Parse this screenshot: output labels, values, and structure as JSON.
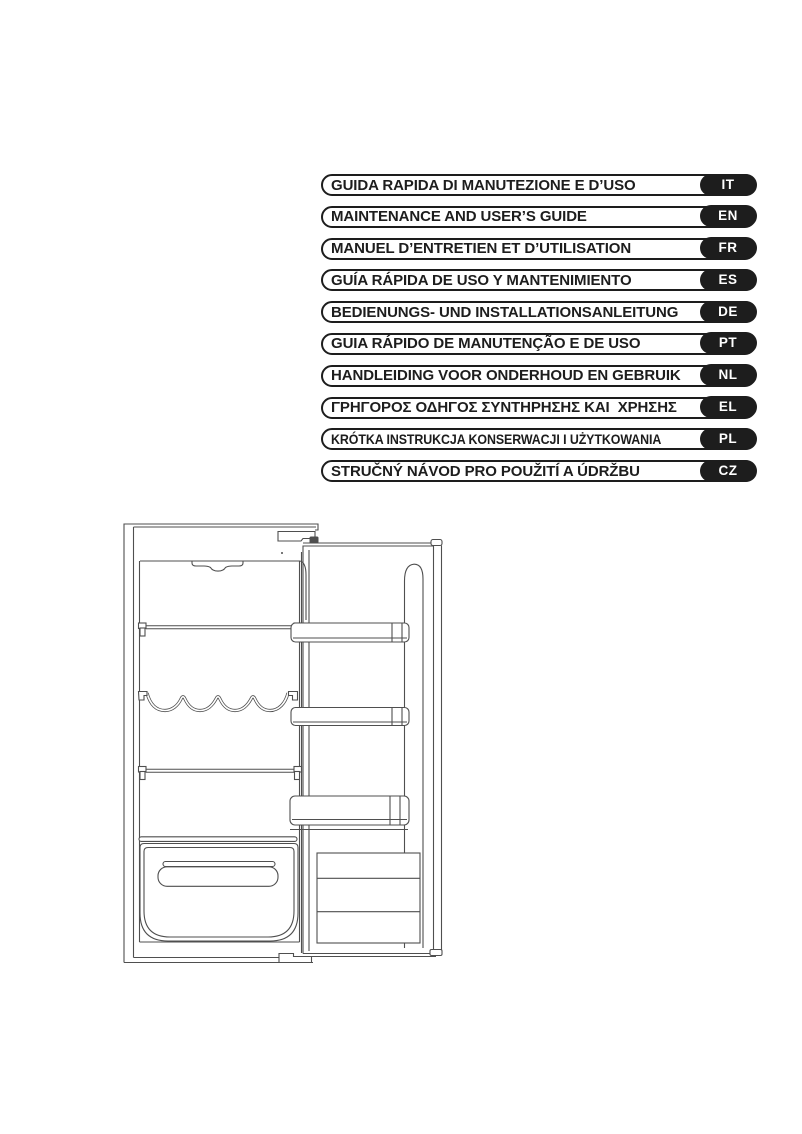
{
  "languages": {
    "pill_border_color": "#1d1d1d",
    "tag_bg_color": "#1d1d1d",
    "tag_text_color": "#ffffff",
    "items": [
      {
        "title": "GUIDA RAPIDA DI MANUTEZIONE E D’USO",
        "code": "IT"
      },
      {
        "title": "MAINTENANCE AND USER’S GUIDE",
        "code": "EN"
      },
      {
        "title": "MANUEL D’ENTRETIEN ET D’UTILISATION",
        "code": "FR"
      },
      {
        "title": "GUÍA RÁPIDA DE USO Y MANTENIMIENTO",
        "code": "ES"
      },
      {
        "title": "BEDIENUNGS- UND INSTALLATIONSANLEITUNG",
        "code": "DE"
      },
      {
        "title": "GUIA RÁPIDO DE MANUTENÇÃO E DE USO",
        "code": "PT"
      },
      {
        "title": "HANDLEIDING VOOR ONDERHOUD EN GEBRUIK",
        "code": "NL"
      },
      {
        "title": "ΓΡΗΓΟΡΟΣ ΟΔΗΓΟΣ ΣΥΝΤΗΡΗΣΗΣ ΚΑΙ  ΧΡΗΣΗΣ",
        "code": "EL"
      },
      {
        "title": "KRÓTKA INSTRUKCJA KONSERWACJI I UŻYTKOWANIA",
        "code": "PL"
      },
      {
        "title": "STRUČNÝ NÁVOD PRO POUŽITÍ A ÚDRŽBU",
        "code": "CZ"
      }
    ]
  },
  "figure": {
    "name": "built-in refrigerator with open door, interior line drawing",
    "line_color": "#4f4f4f"
  }
}
